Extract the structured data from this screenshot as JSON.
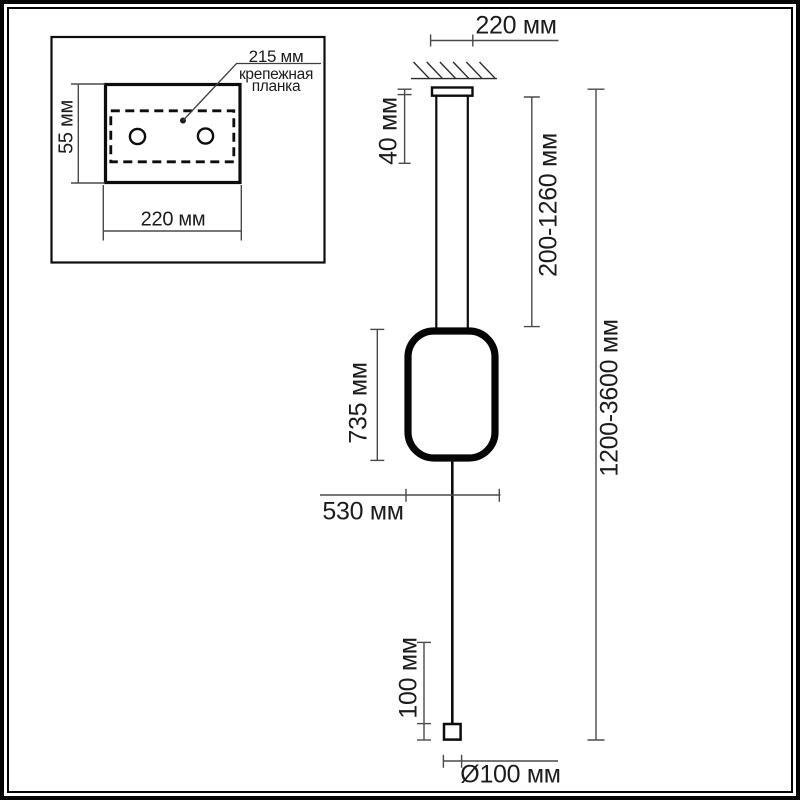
{
  "colors": {
    "ink": "#111111",
    "dim_line": "#4a4a4a",
    "background": "#ffffff"
  },
  "inset": {
    "plate_offset": "215 мм",
    "plate_name_line1": "крепежная",
    "plate_name_line2": "планка",
    "plate_height": "55 мм",
    "plate_width": "220 мм"
  },
  "main": {
    "canopy_width": "220 мм",
    "canopy_height": "40 мм",
    "suspension_range": "200-1260 мм",
    "overall_range": "1200-3600 мм",
    "shade_height": "735 мм",
    "shade_width": "530 мм",
    "counterweight_height": "100 мм",
    "counterweight_diameter": "Ø100 мм"
  }
}
